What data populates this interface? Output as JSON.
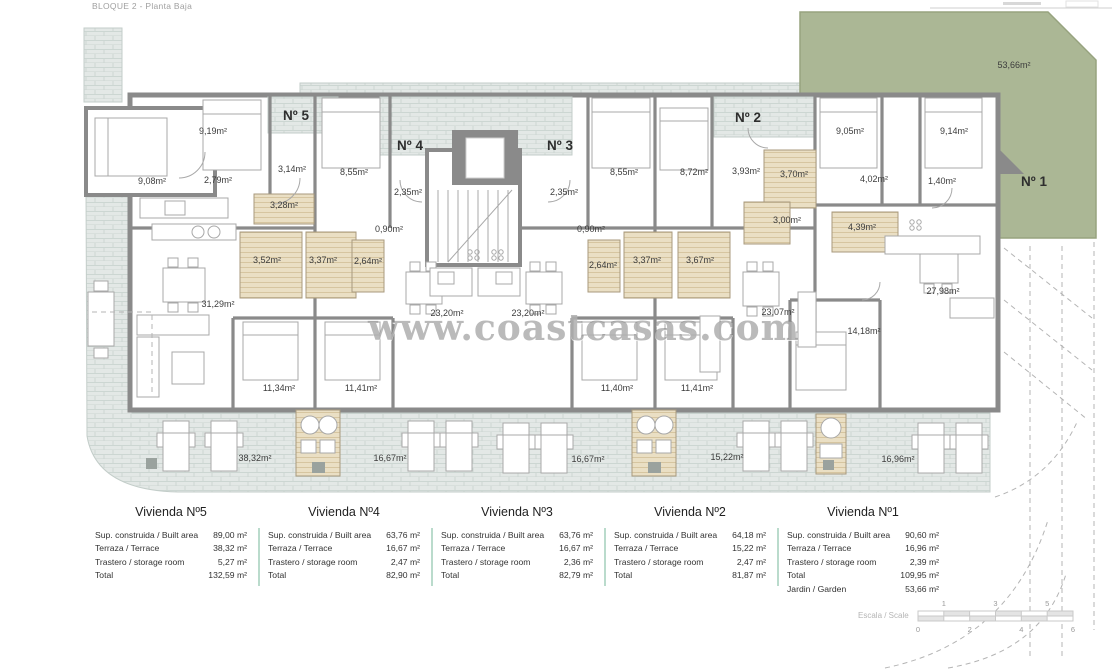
{
  "header": {
    "title": "BLOQUE 2 - Planta Baja"
  },
  "watermark": "www.coastcasas.com",
  "plan": {
    "colors": {
      "garden": "#abb795",
      "terrace_tile": "#e3e8e6",
      "wall": "#8a8a8a",
      "bathroom_floor": "#eadfc4",
      "table_divider": "#badbcc"
    },
    "unit_labels": [
      {
        "text": "Nº 5",
        "x": 296,
        "y": 120
      },
      {
        "text": "Nº 4",
        "x": 410,
        "y": 150
      },
      {
        "text": "Nº 3",
        "x": 560,
        "y": 150
      },
      {
        "text": "Nº 2",
        "x": 748,
        "y": 122
      },
      {
        "text": "Nº 1",
        "x": 1034,
        "y": 186
      }
    ],
    "room_labels": [
      {
        "text": "9,08m²",
        "x": 152,
        "y": 184
      },
      {
        "text": "9,19m²",
        "x": 213,
        "y": 134
      },
      {
        "text": "2,79m²",
        "x": 218,
        "y": 183
      },
      {
        "text": "3,14m²",
        "x": 292,
        "y": 172
      },
      {
        "text": "8,55m²",
        "x": 354,
        "y": 175
      },
      {
        "text": "3,28m²",
        "x": 284,
        "y": 208
      },
      {
        "text": "3,52m²",
        "x": 267,
        "y": 263
      },
      {
        "text": "3,37m²",
        "x": 323,
        "y": 263
      },
      {
        "text": "2,64m²",
        "x": 368,
        "y": 264
      },
      {
        "text": "31,29m²",
        "x": 218,
        "y": 307
      },
      {
        "text": "2,35m²",
        "x": 408,
        "y": 195
      },
      {
        "text": "0,90m²",
        "x": 389,
        "y": 232
      },
      {
        "text": "23,20m²",
        "x": 447,
        "y": 316
      },
      {
        "text": "23,20m²",
        "x": 528,
        "y": 316
      },
      {
        "text": "2,35m²",
        "x": 564,
        "y": 195
      },
      {
        "text": "0,90m²",
        "x": 591,
        "y": 232
      },
      {
        "text": "8,55m²",
        "x": 624,
        "y": 175
      },
      {
        "text": "2,64m²",
        "x": 603,
        "y": 268
      },
      {
        "text": "3,37m²",
        "x": 647,
        "y": 263
      },
      {
        "text": "3,67m²",
        "x": 700,
        "y": 263
      },
      {
        "text": "8,72m²",
        "x": 694,
        "y": 175
      },
      {
        "text": "3,93m²",
        "x": 746,
        "y": 174
      },
      {
        "text": "3,70m²",
        "x": 794,
        "y": 177
      },
      {
        "text": "3,00m²",
        "x": 787,
        "y": 223
      },
      {
        "text": "23,07m²",
        "x": 778,
        "y": 315
      },
      {
        "text": "9,05m²",
        "x": 850,
        "y": 134
      },
      {
        "text": "9,14m²",
        "x": 954,
        "y": 134
      },
      {
        "text": "4,02m²",
        "x": 874,
        "y": 182
      },
      {
        "text": "1,40m²",
        "x": 942,
        "y": 184
      },
      {
        "text": "4,39m²",
        "x": 862,
        "y": 230
      },
      {
        "text": "27,98m²",
        "x": 943,
        "y": 294
      },
      {
        "text": "14,18m²",
        "x": 864,
        "y": 334
      },
      {
        "text": "11,34m²",
        "x": 279,
        "y": 391
      },
      {
        "text": "11,41m²",
        "x": 361,
        "y": 391
      },
      {
        "text": "11,40m²",
        "x": 617,
        "y": 391
      },
      {
        "text": "11,41m²",
        "x": 697,
        "y": 391
      },
      {
        "text": "38,32m²",
        "x": 255,
        "y": 461
      },
      {
        "text": "16,67m²",
        "x": 390,
        "y": 461
      },
      {
        "text": "16,67m²",
        "x": 588,
        "y": 462
      },
      {
        "text": "15,22m²",
        "x": 727,
        "y": 460
      },
      {
        "text": "16,96m²",
        "x": 898,
        "y": 462
      },
      {
        "text": "53,66m²",
        "x": 1014,
        "y": 68
      }
    ]
  },
  "apartments": [
    {
      "name": "Vivienda Nº5",
      "rows": [
        {
          "label": "Sup. construida / Built area",
          "value": "89,00 m²"
        },
        {
          "label": "Terraza / Terrace",
          "value": "38,32 m²"
        },
        {
          "label": "Trastero / storage room",
          "value": "5,27 m²"
        },
        {
          "label": "Total",
          "value": "132,59 m²"
        }
      ]
    },
    {
      "name": "Vivienda Nº4",
      "rows": [
        {
          "label": "Sup. construida / Built area",
          "value": "63,76 m²"
        },
        {
          "label": "Terraza / Terrace",
          "value": "16,67 m²"
        },
        {
          "label": "Trastero / storage room",
          "value": "2,47 m²"
        },
        {
          "label": "Total",
          "value": "82,90 m²"
        }
      ]
    },
    {
      "name": "Vivienda Nº3",
      "rows": [
        {
          "label": "Sup. construida / Built area",
          "value": "63,76 m²"
        },
        {
          "label": "Terraza / Terrace",
          "value": "16,67 m²"
        },
        {
          "label": "Trastero / storage room",
          "value": "2,36 m²"
        },
        {
          "label": "Total",
          "value": "82,79 m²"
        }
      ]
    },
    {
      "name": "Vivienda Nº2",
      "rows": [
        {
          "label": "Sup. construida / Built area",
          "value": "64,18 m²"
        },
        {
          "label": "Terraza / Terrace",
          "value": "15,22 m²"
        },
        {
          "label": "Trastero / storage room",
          "value": "2,47 m²"
        },
        {
          "label": "Total",
          "value": "81,87 m²"
        }
      ]
    },
    {
      "name": "Vivienda Nº1",
      "rows": [
        {
          "label": "Sup. construida / Built area",
          "value": "90,60 m²"
        },
        {
          "label": "Terraza / Terrace",
          "value": "16,96 m²"
        },
        {
          "label": "Trastero / storage room",
          "value": "2,39 m²"
        },
        {
          "label": "Total",
          "value": "109,95 m²"
        },
        {
          "label": "Jardin / Garden",
          "value": "53,66 m²"
        }
      ]
    }
  ],
  "scale": {
    "label": "Escala / Scale",
    "top_ticks": [
      "1",
      "3",
      "5"
    ],
    "bottom_ticks": [
      "0",
      "2",
      "4",
      "6"
    ]
  }
}
